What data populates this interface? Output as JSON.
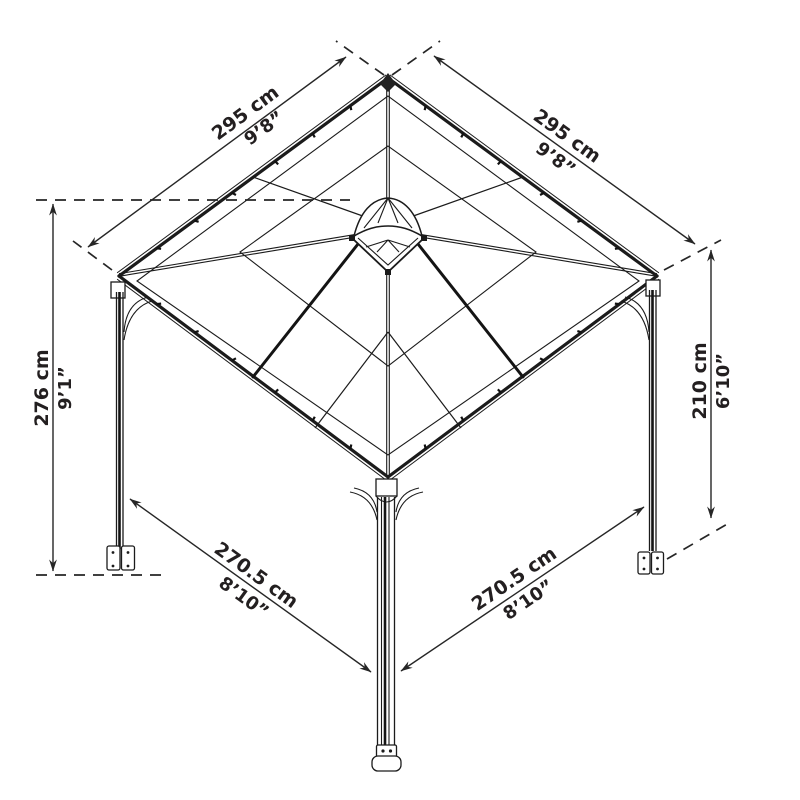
{
  "figure": {
    "subject": "gazebo-dimension-diagram",
    "background_color": "#ffffff",
    "line_color": "#1b1b1b",
    "text_color": "#231f20"
  },
  "dimensions": {
    "roof_edge_left": {
      "cm": "295 cm",
      "imperial": "9’8”"
    },
    "roof_edge_right": {
      "cm": "295 cm",
      "imperial": "9’8”"
    },
    "height_total": {
      "cm": "276 cm",
      "imperial": "9’1”"
    },
    "height_eave": {
      "cm": "210 cm",
      "imperial": "6’10”"
    },
    "post_span_left": {
      "cm": "270.5 cm",
      "imperial": "8’10”"
    },
    "post_span_right": {
      "cm": "270.5 cm",
      "imperial": "8’10”"
    }
  }
}
